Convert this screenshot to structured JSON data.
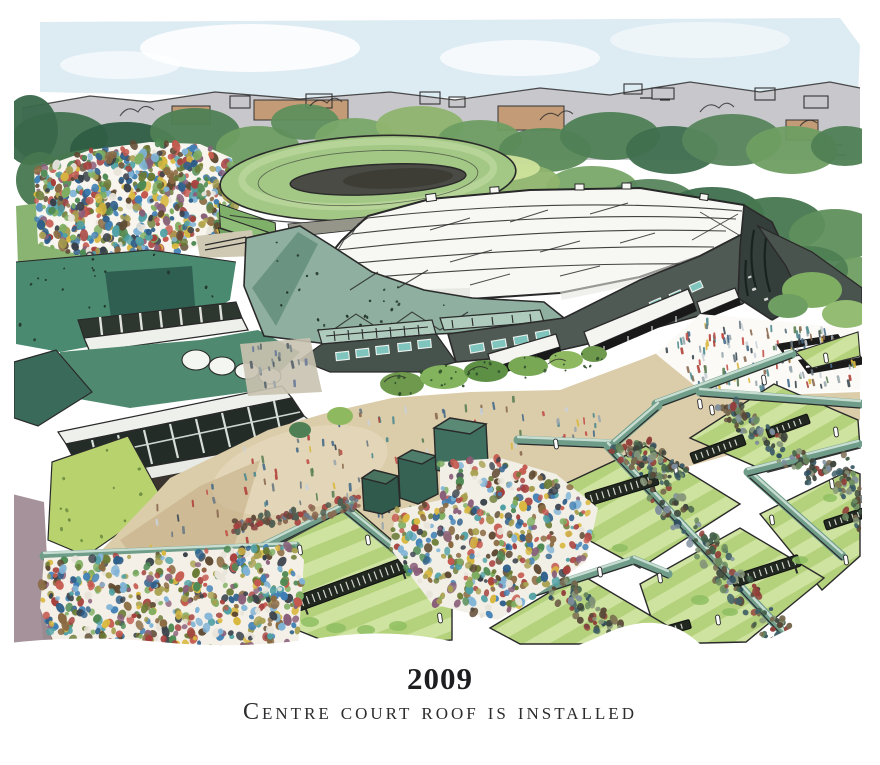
{
  "caption": {
    "year": "2009",
    "title": "Centre court roof is installed"
  },
  "illustration": {
    "alt": "Watercolour aerial illustration of the Wimbledon grounds: Centre Court with its new translucent roof, No.1 Court, outside grass courts, stands and crowds",
    "palette": {
      "sky": "#d9e9f2",
      "skyline": "#c8c8cc",
      "building_tan": "#c49b77",
      "tree_dark": "#39684a",
      "tree_mid": "#6f9e62",
      "tree_light": "#a9c87f",
      "lawn": "#c2db96",
      "slope_green": "#4a8a70",
      "roof_white": "#f7f7f3",
      "rim_teal": "#8fb0a0",
      "facade_slate": "#4f5a54",
      "tower_dark": "#343e3a",
      "window_teal": "#7fc4bd",
      "concourse_tan": "#dccdaa",
      "court_light": "#cfe3a0",
      "court_stripe": "#b4d17c",
      "wall_teal": "#6f9d8a",
      "hoarding_dark": "#20281f",
      "corner_mauve": "#a5929b",
      "ink": "#2a2a2a",
      "crowd_colors": [
        "#3f7fb5",
        "#7fb3d6",
        "#d9b840",
        "#a63f3c",
        "#c4584e",
        "#4f8a54",
        "#7fae62",
        "#8a6a42",
        "#5f4a33",
        "#4fa0a5",
        "#e8e4da",
        "#39414b",
        "#8a5f7a",
        "#a8a050",
        "#6a7a35",
        "#2e5f8a"
      ],
      "hedge_colors": [
        "#44604a",
        "#6a8a5f",
        "#584838",
        "#76684e",
        "#3f5f68",
        "#87977a",
        "#3c443c",
        "#7c8c9c",
        "#913f3a",
        "#2f4f5f"
      ],
      "figure_colors": [
        "#6c7a84",
        "#9aa7ad",
        "#4f8a8f",
        "#b0413a",
        "#d9b840",
        "#5b7f55",
        "#8a6a52",
        "#3d4a52",
        "#c9d2d8",
        "#476b8a",
        "#c25048"
      ],
      "maroon_crowd_colors": [
        "#7c3f3f",
        "#93524a",
        "#5f4a3a",
        "#8a6a52",
        "#a63f3c",
        "#4f5f52",
        "#6a7a8a"
      ],
      "pocket_colors": [
        "#7a858a",
        "#9aa5a8",
        "#55606a",
        "#6a7a9a"
      ],
      "speckle": "#203428",
      "bush_speckle": "#2f4f2a",
      "lime_speckle": "#6a8a3f"
    }
  }
}
